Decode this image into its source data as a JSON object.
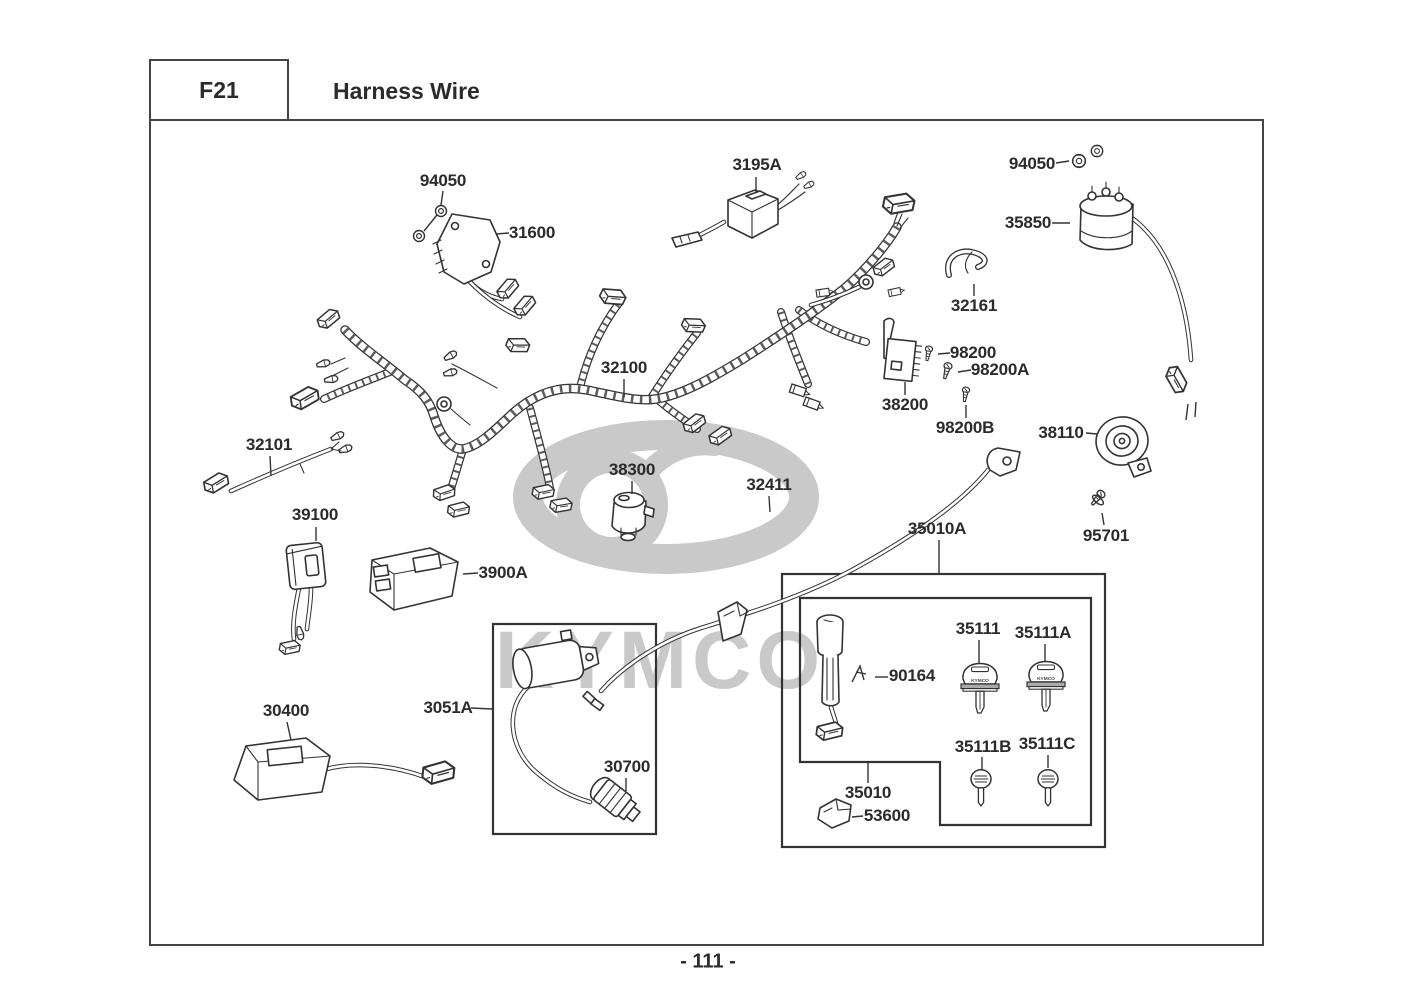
{
  "header": {
    "code": "F21",
    "title": "Harness Wire"
  },
  "footer": {
    "page_number": "- 111 -"
  },
  "watermark": {
    "brand": "KYMCO"
  },
  "key_set": {
    "key_brand": "KYMCO"
  },
  "parts": [
    "94050",
    "31600",
    "3195A",
    "94050",
    "35850",
    "32161",
    "32100",
    "98200",
    "98200A",
    "38200",
    "98200B",
    "38110",
    "32101",
    "38300",
    "32411",
    "35010A",
    "95701",
    "39100",
    "3900A",
    "35111",
    "35111A",
    "90164",
    "30400",
    "3051A",
    "30700",
    "35111B",
    "35111C",
    "35010",
    "53600"
  ]
}
